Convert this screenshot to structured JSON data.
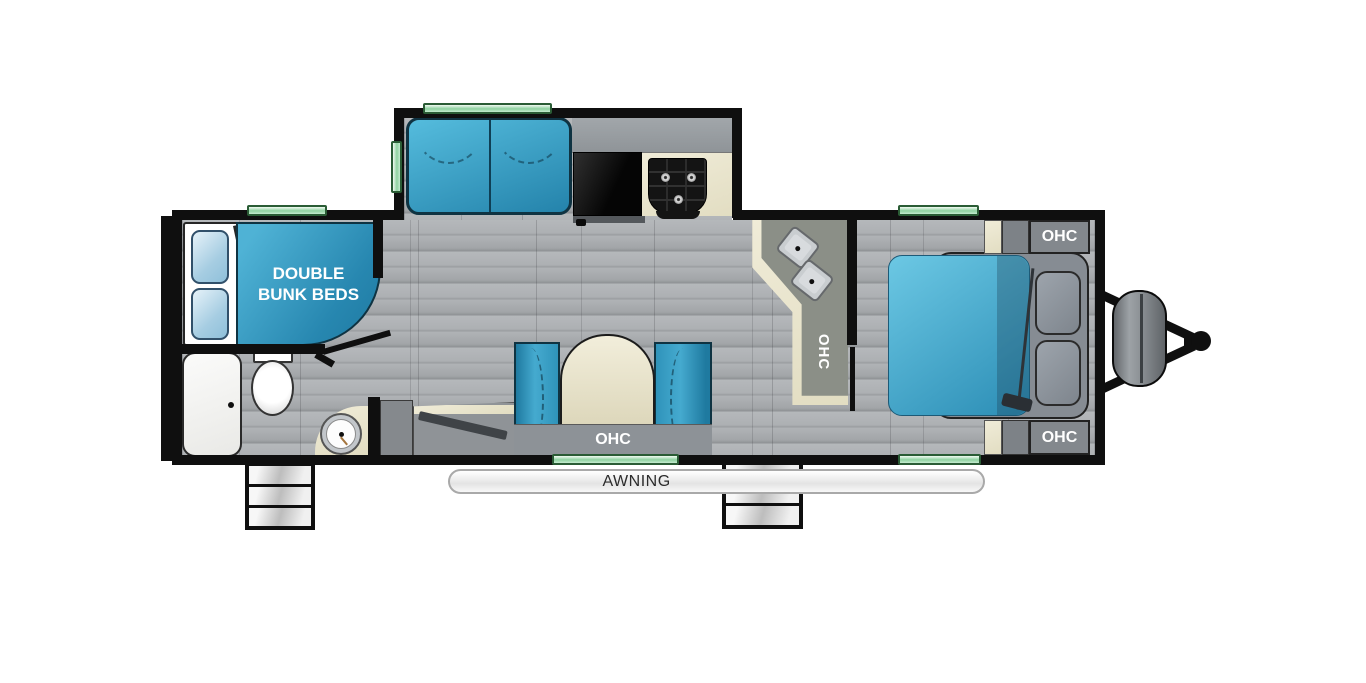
{
  "plan": {
    "bunk_label_line1": "DOUBLE",
    "bunk_label_line2": "BUNK BEDS",
    "dinette_ohc": "OHC",
    "counter_ohc": "OHC",
    "bed_ohc_top": "OHC",
    "bed_ohc_bottom": "OHC",
    "awning": "AWNING",
    "colors": {
      "furniture_teal_light": "#4fb2d5",
      "furniture_teal_dark": "#1f7aa2",
      "bed_blue_light": "#63c3e0",
      "bed_blue_dark": "#2b8db5",
      "wall": "#0f0f0f",
      "floor_gray": "#a8abae",
      "cabinet_gray": "#8d9296",
      "counter_cream": "#ebe7d1",
      "window_green": "#8fd2a1"
    }
  }
}
